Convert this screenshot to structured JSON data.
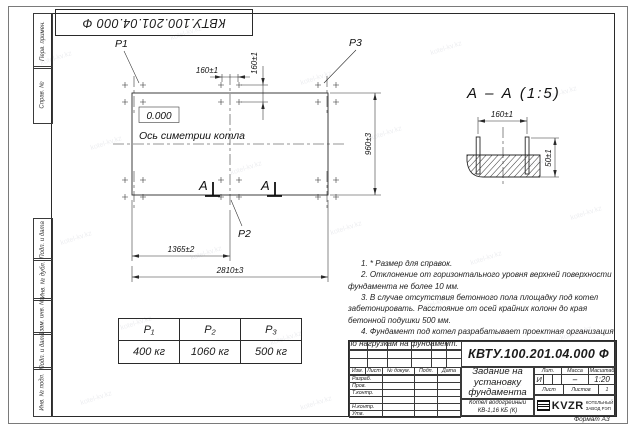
{
  "doc_number": "КВТУ.100.201.04.000 Ф",
  "watermark": "kotel-kv.kz",
  "frame": {
    "format_label": "Формат А3",
    "left_top_cells": [
      "Перв. примен.",
      "Справ. №"
    ],
    "left_bottom_cells": [
      "Подп. и дата",
      "Инв. № дубл.",
      "Взам. инв. №",
      "Подп. и дата",
      "Инв. № подл."
    ]
  },
  "plan": {
    "p1": "P1",
    "p2": "P2",
    "p3": "P3",
    "level_mark": "0.000",
    "axis_label": "Ось симетрии котла",
    "section_letter": "А",
    "dim_160_top": "160±1",
    "dim_160_vert": "160±1",
    "dim_960": "960±3",
    "dim_1365": "1365±2",
    "dim_2810": "2810±3"
  },
  "section": {
    "title": "А – А (1:5)",
    "dim_160": "160±1",
    "dim_50": "50±1"
  },
  "notes": [
    "1. * Размер для справок.",
    "2. Отклонение от горизонтального уровня верхней поверхности фундамента не более 10 мм.",
    "3. В случае отсутствия бетонного пола площадку под котел забетонировать. Расстояние от осей крайних колонн до края бетонной подушки 500 мм.",
    "4. Фундамент под котел разрабатывает проектная организация по нагрузкам на фундамент."
  ],
  "load_table": {
    "headers": [
      "P₁",
      "P₂",
      "P₃"
    ],
    "values": [
      "400 кг",
      "1060 кг",
      "500 кг"
    ]
  },
  "title_block": {
    "doc_number": "КВТУ.100.201.04.000 Ф",
    "title": "Задание на установку фундамента",
    "product_line1": "Котел водогрейный",
    "product_line2": "КВ-1,16 КБ (К)",
    "col_izm": "Изм.",
    "col_list": "Лист",
    "col_doc": "№ докум.",
    "col_sign": "Подп.",
    "col_date": "Дата",
    "row_labels": [
      "Разраб.",
      "Пров.",
      "Т.контр.",
      "",
      "Н.контр.",
      "Утв."
    ],
    "lit_header": "Лит.",
    "mass_header": "Масса",
    "scale_header": "Масштаб",
    "lit_value": "И",
    "mass_value": "–",
    "scale_value": "1:20",
    "sheet_label": "Лист",
    "sheets_label": "Листов",
    "sheets_value": "1",
    "company_name": "KVZR",
    "company_sub1": "КОТЕЛЬНЫЙ",
    "company_sub2": "ЗАВОД РЭП"
  }
}
